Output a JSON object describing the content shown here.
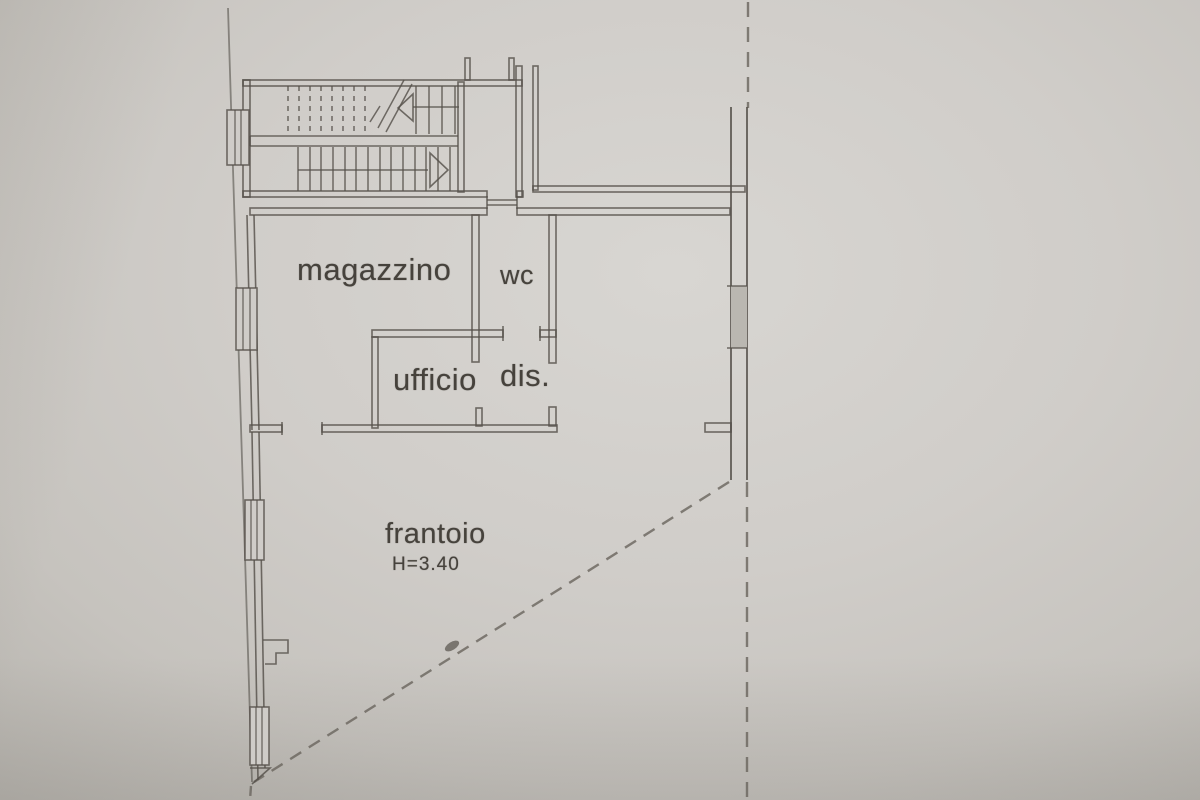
{
  "plan": {
    "type": "floor-plan-photo",
    "rooms": [
      {
        "id": "magazzino",
        "label": "magazzino"
      },
      {
        "id": "wc",
        "label": "wc"
      },
      {
        "id": "ufficio",
        "label": "ufficio"
      },
      {
        "id": "dis",
        "label": "dis."
      },
      {
        "id": "frantoio",
        "label": "frantoio",
        "height_note": "H=3.40"
      }
    ],
    "colors": {
      "paper": "#cfccc8",
      "ink": "#55514b",
      "boundary_dash": "#6b675f",
      "window_shade": "#bab7b1"
    }
  }
}
